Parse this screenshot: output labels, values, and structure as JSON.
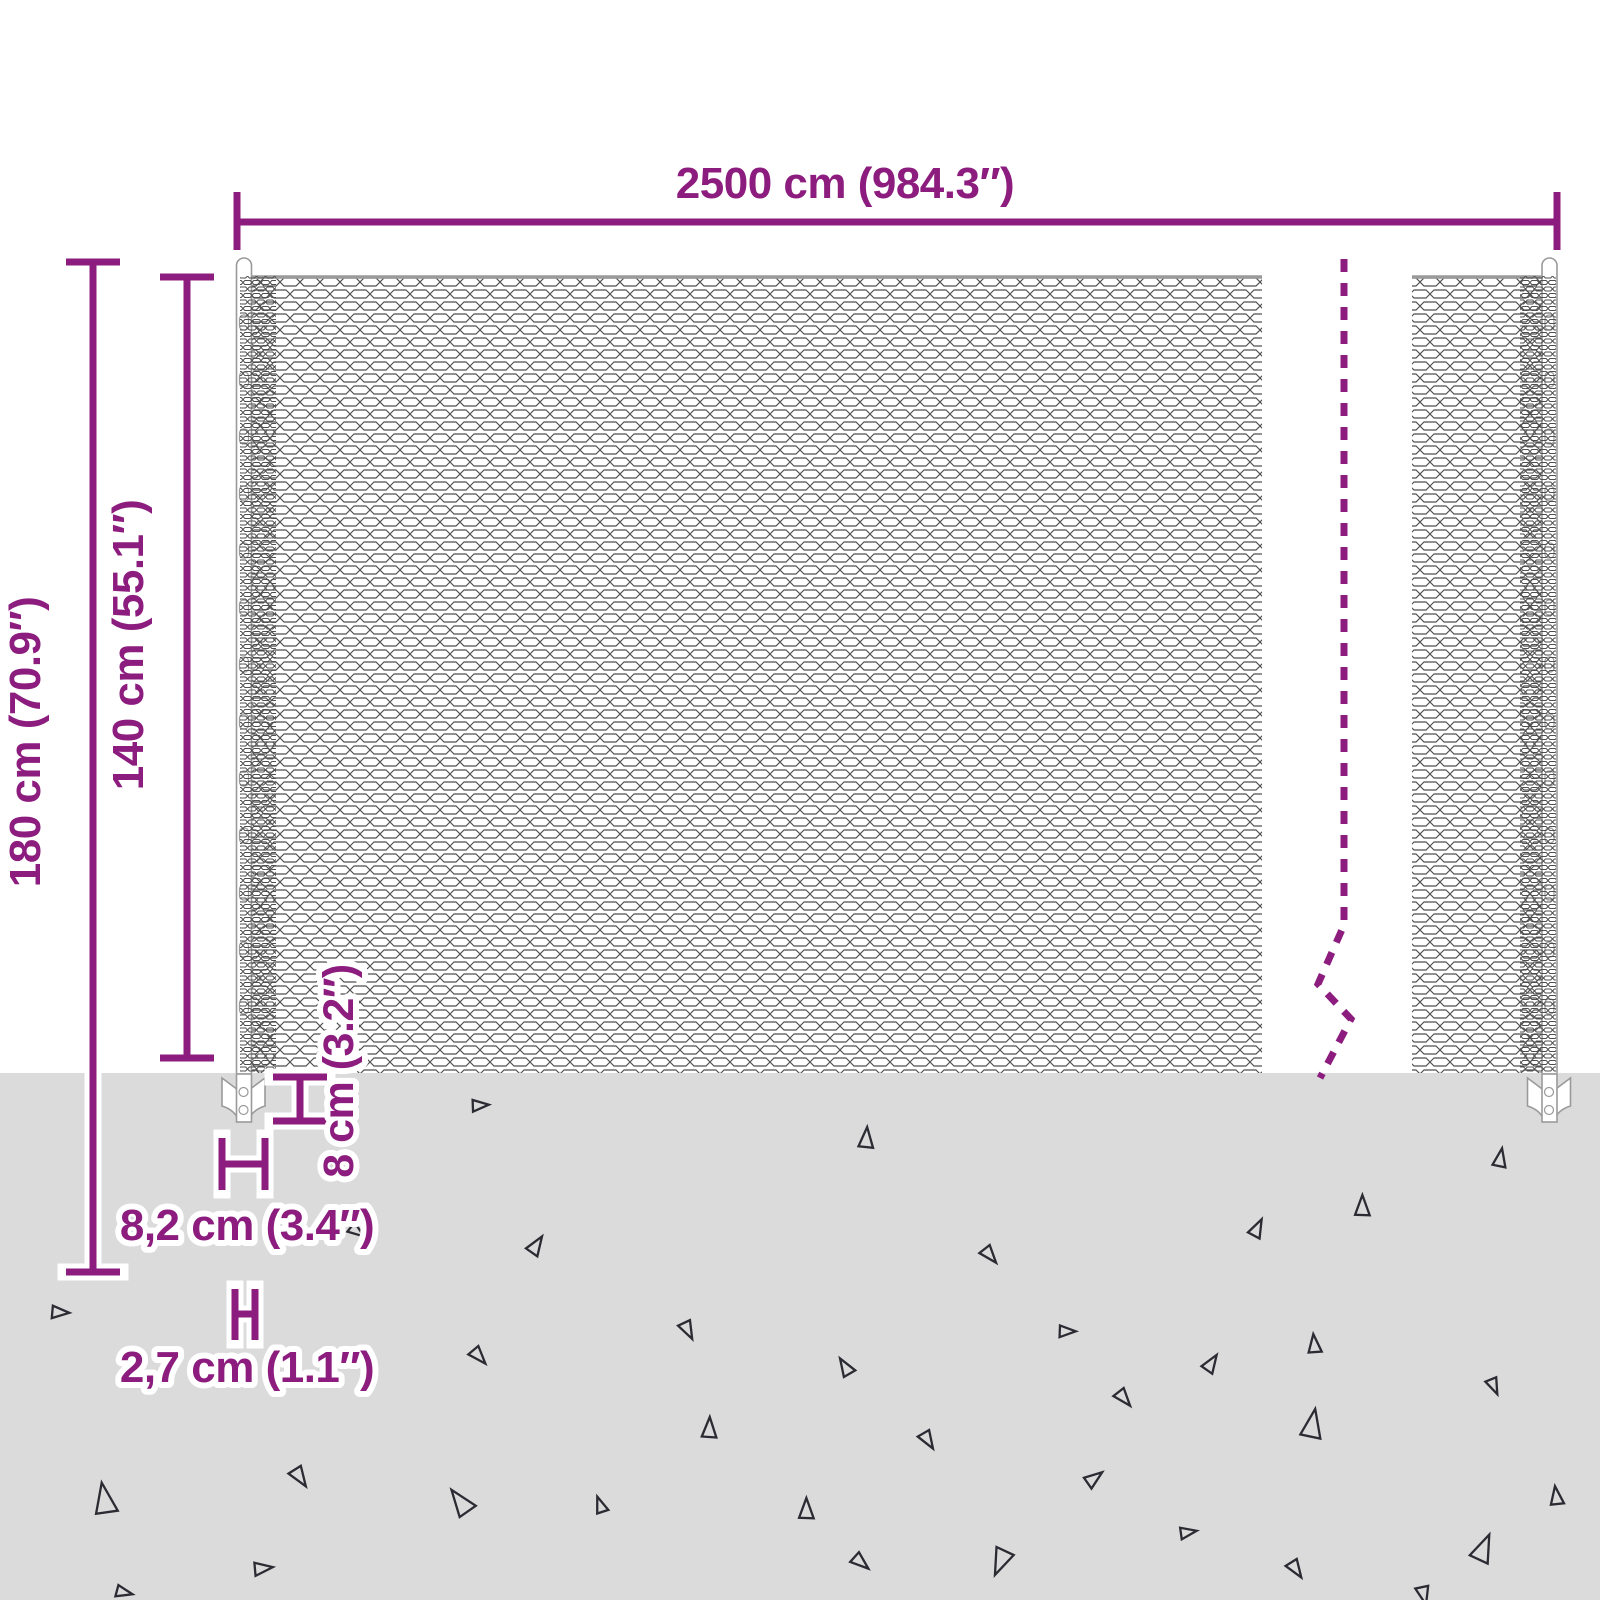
{
  "colors": {
    "accent_purple": "#8C1D7F",
    "ground_gray": "#DCDBDB",
    "mesh_wire_gray": "#4F4F4F",
    "steel_outline_gray": "#9A9A9A",
    "triangle_dark": "#2B2B33"
  },
  "dimensions": {
    "total_width": "2500 cm (984.3″)",
    "total_height": "180 cm (70.9″)",
    "mesh_height": "140 cm (55.1″)",
    "anchor_plate_height": "8 cm (3.2″)",
    "anchor_plate_width": "8,2 cm (3.4″)",
    "post_width": "2,7 cm (1.1″)"
  },
  "ground": {
    "triangles": [
      [
        60,
        1312,
        17,
        95
      ],
      [
        104,
        1499,
        30,
        -8
      ],
      [
        124,
        1592,
        16,
        105
      ],
      [
        357,
        1231,
        16,
        128
      ],
      [
        536,
        1245,
        19,
        35
      ],
      [
        688,
        1330,
        18,
        155
      ],
      [
        479,
        1356,
        18,
        140
      ],
      [
        709,
        1428,
        20,
        4
      ],
      [
        300,
        1477,
        20,
        148
      ],
      [
        460,
        1502,
        27,
        -35
      ],
      [
        263,
        1568,
        18,
        85
      ],
      [
        600,
        1505,
        16,
        -18
      ],
      [
        845,
        1367,
        18,
        -30
      ],
      [
        990,
        1255,
        18,
        142
      ],
      [
        866,
        1138,
        20,
        6
      ],
      [
        480,
        1105,
        16,
        88
      ],
      [
        1257,
        1228,
        18,
        28
      ],
      [
        1362,
        1206,
        20,
        2
      ],
      [
        1500,
        1158,
        18,
        12
      ],
      [
        1067,
        1331,
        16,
        92
      ],
      [
        1211,
        1363,
        18,
        35
      ],
      [
        1314,
        1344,
        18,
        -4
      ],
      [
        1494,
        1386,
        16,
        158
      ],
      [
        1124,
        1398,
        18,
        142
      ],
      [
        1312,
        1424,
        28,
        12
      ],
      [
        928,
        1440,
        18,
        150
      ],
      [
        1094,
        1478,
        18,
        55
      ],
      [
        806,
        1509,
        20,
        2
      ],
      [
        1556,
        1496,
        18,
        -6
      ],
      [
        1188,
        1532,
        16,
        82
      ],
      [
        1483,
        1548,
        27,
        25
      ],
      [
        861,
        1562,
        18,
        132
      ],
      [
        1001,
        1562,
        26,
        -155
      ],
      [
        1296,
        1569,
        18,
        148
      ],
      [
        1424,
        1595,
        18,
        168
      ]
    ]
  },
  "posts": {
    "clip_rows_y_start": 315,
    "clip_rows_y_end": 1030,
    "clip_step": 57,
    "centers_x": [
      244,
      1549.5
    ]
  }
}
